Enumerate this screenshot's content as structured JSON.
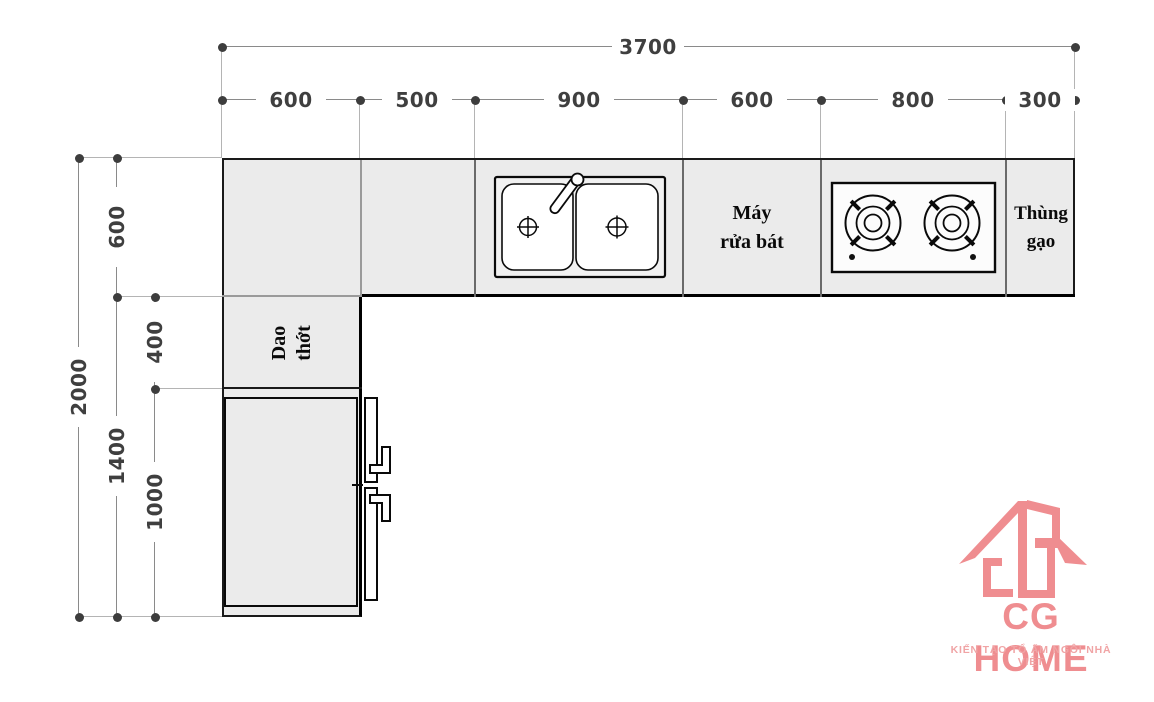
{
  "colors": {
    "counter_fill": "#ebebeb",
    "outline": "#1a1a1a",
    "dimension_line": "#8a8a8a",
    "dimension_text": "#3f3f3f",
    "logo_brand": "#ef8d90",
    "logo_tagline": "#f0a4a5"
  },
  "dims": {
    "total_width": "3700",
    "width_segments": [
      "600",
      "500",
      "900",
      "600",
      "800",
      "300"
    ],
    "total_height": "2000",
    "height_segments": [
      "600",
      "1400"
    ],
    "height_inner_segments": [
      "400",
      "1000"
    ]
  },
  "fixtures": {
    "cutting_board": {
      "line1": "Dao",
      "line2": "thớt"
    },
    "dishwasher": {
      "line1": "Máy",
      "line2": "rửa bát"
    },
    "rice_bin": {
      "line1": "Thùng",
      "line2": "gạo"
    }
  },
  "logo": {
    "brand": "CG HOME",
    "tagline": "KIẾN TẠO TỔ ẤM NGÔI NHÀ VIỆT",
    "brand_color": "#ef8d90",
    "tagline_color": "#f0a4a5"
  }
}
